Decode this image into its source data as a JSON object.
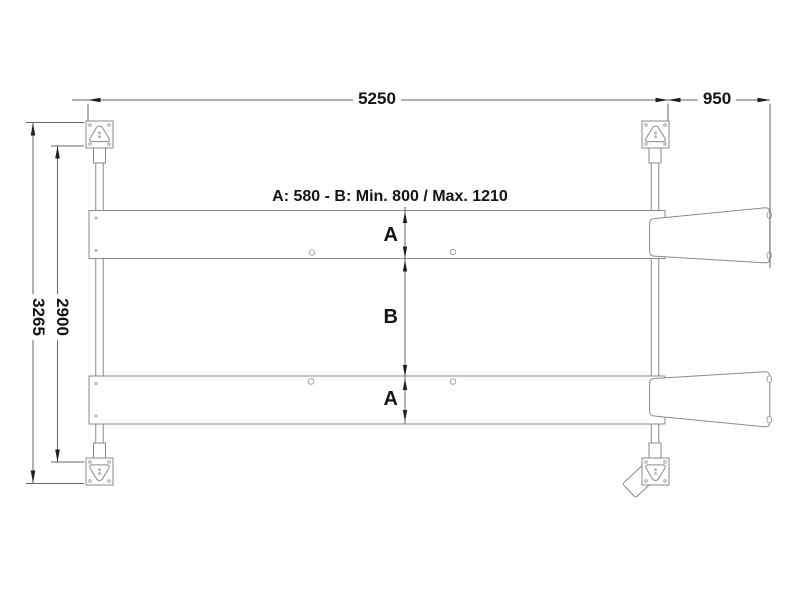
{
  "drawing": {
    "note": "A: 580 - B: Min. 800 / Max. 1210",
    "dimensions": {
      "top_length": "5250",
      "top_ramp": "950",
      "left_outer": "3265",
      "left_inner": "2900"
    },
    "section_labels": {
      "a_top": "A",
      "b_middle": "B",
      "a_bottom": "A"
    },
    "colors": {
      "background": "#ffffff",
      "structure_line": "#8a8a8a",
      "detail_line": "#a5a5a5",
      "dimension_line": "#666666",
      "arrowhead": "#1f1f1f",
      "text": "#141414"
    }
  }
}
